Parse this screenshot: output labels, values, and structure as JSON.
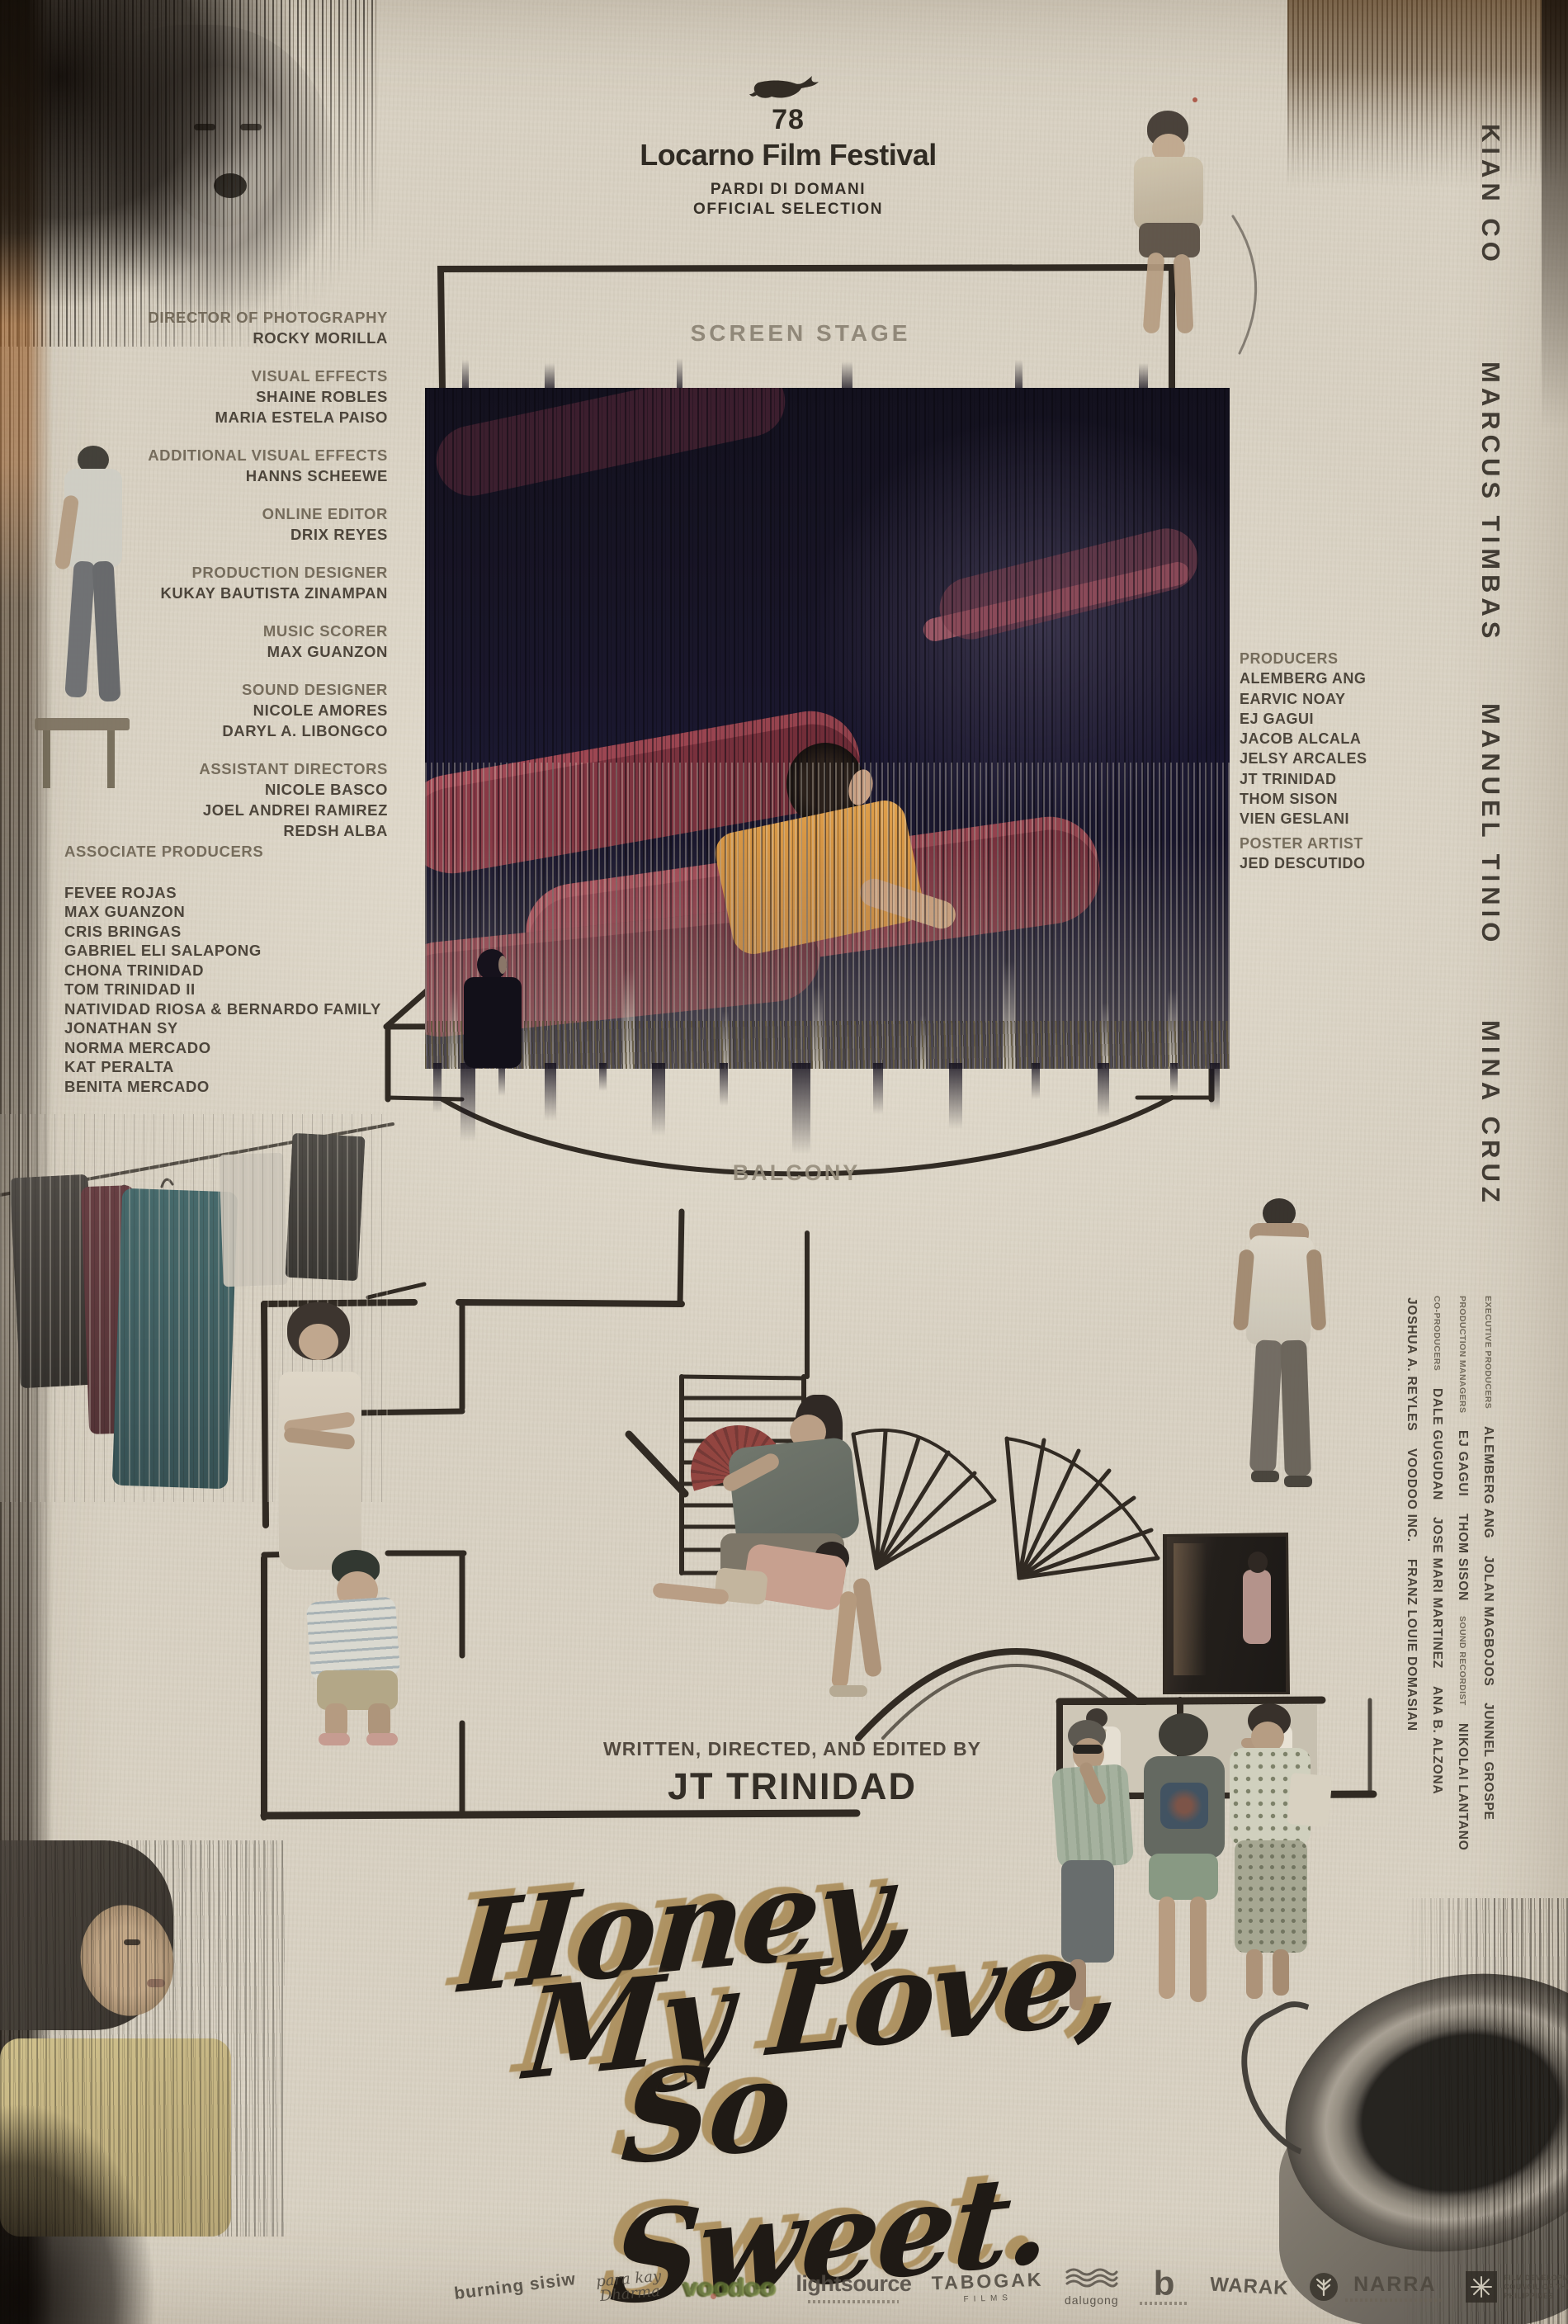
{
  "festival": {
    "edition": "78",
    "name": "Locarno Film Festival",
    "section1": "PARDI DI DOMANI",
    "section2": "OFFICIAL SELECTION"
  },
  "theater": {
    "screen_label": "SCREEN STAGE",
    "balcony_label": "BALCONY"
  },
  "credits_left": [
    {
      "role": "DIRECTOR OF PHOTOGRAPHY",
      "names": [
        "ROCKY MORILLA"
      ]
    },
    {
      "role": "VISUAL EFFECTS",
      "names": [
        "SHAINE ROBLES",
        "MARIA ESTELA PAISO"
      ]
    },
    {
      "role": "ADDITIONAL VISUAL EFFECTS",
      "names": [
        "HANNS SCHEEWE"
      ]
    },
    {
      "role": "ONLINE EDITOR",
      "names": [
        "DRIX REYES"
      ]
    },
    {
      "role": "PRODUCTION DESIGNER",
      "names": [
        "KUKAY BAUTISTA ZINAMPAN"
      ]
    },
    {
      "role": "MUSIC SCORER",
      "names": [
        "MAX GUANZON"
      ]
    },
    {
      "role": "SOUND DESIGNER",
      "names": [
        "NICOLE AMORES",
        "DARYL A. LIBONGCO"
      ]
    },
    {
      "role": "ASSISTANT DIRECTORS",
      "names": [
        "NICOLE BASCO",
        "JOEL ANDREI RAMIREZ",
        "REDSH ALBA"
      ]
    }
  ],
  "associate_producers": {
    "title": "ASSOCIATE PRODUCERS",
    "names": [
      "FEVEE ROJAS",
      "MAX GUANZON",
      "CRIS BRINGAS",
      "GABRIEL ELI SALAPONG",
      "CHONA TRINIDAD",
      "TOM TRINIDAD II",
      "NATIVIDAD RIOSA & BERNARDO FAMILY",
      "JONATHAN SY",
      "NORMA MERCADO",
      "KAT PERALTA",
      "BENITA MERCADO"
    ]
  },
  "producers": {
    "title": "PRODUCERS",
    "names": [
      "ALEMBERG ANG",
      "EARVIC NOAY",
      "EJ GAGUI",
      "JACOB ALCALA",
      "JELSY ARCALES",
      "JT TRINIDAD",
      "THOM SISON",
      "VIEN GESLANI"
    ]
  },
  "poster_artist": {
    "title": "POSTER ARTIST",
    "name": "JED DESCUTIDO"
  },
  "cast": [
    "KIAN CO",
    "MARCUS TIMBAS",
    "MANUEL TINIO",
    "MINA CRUZ"
  ],
  "side_credits": [
    {
      "items": [
        {
          "t": "label",
          "text": "EXECUTIVE PRODUCERS"
        },
        {
          "t": "name",
          "text": "ALEMBERG ANG"
        },
        {
          "t": "name",
          "text": "JOLAN MAGBOJOS"
        },
        {
          "t": "name",
          "text": "JUNNEL GROSPE"
        }
      ]
    },
    {
      "items": [
        {
          "t": "label",
          "text": "PRODUCTION MANAGERS"
        },
        {
          "t": "name",
          "text": "EJ GAGUI"
        },
        {
          "t": "name",
          "text": "THOM SISON"
        },
        {
          "t": "label",
          "text": "SOUND RECORDIST"
        },
        {
          "t": "name",
          "text": "NIKOLAI LANTANO"
        }
      ]
    },
    {
      "items": [
        {
          "t": "label",
          "text": "CO-PRODUCERS"
        },
        {
          "t": "name",
          "text": "DALE GUGUDAN"
        },
        {
          "t": "name",
          "text": "JOSE MARI MARTINEZ"
        },
        {
          "t": "name",
          "text": "ANA B. ALZONA"
        }
      ]
    },
    {
      "items": [
        {
          "t": "name",
          "text": "JOSHUA A. REYLES"
        },
        {
          "t": "name",
          "text": "VOODOO INC."
        },
        {
          "t": "name",
          "text": "FRANZ LOUIE DOMASIAN"
        }
      ]
    }
  ],
  "billing": {
    "credit": "WRITTEN, DIRECTED, AND EDITED BY",
    "name": "JT TRINIDAD"
  },
  "title": {
    "line1": "Honey,",
    "line2": "My Love,",
    "line3": "So Sweet."
  },
  "logos": {
    "burning": "burning sisiw",
    "para1": "para kay",
    "para2": "Dharma",
    "voodoo": "voodoo",
    "lightsource": "lightsource",
    "tabogak": "TABOGAK",
    "tabogak_sub": "FILMS",
    "dalugong": "dalugong",
    "b": "b",
    "warak": "WARAK",
    "narra": "NARRA",
    "fdcp": "FILM DEVELOPMENT COUNCIL OF THE PHILIPPINES"
  },
  "colors": {
    "paper": "#d8d1c2",
    "ink": "#241f19",
    "title_gold": "#b1945f",
    "seat_red": "#a04250",
    "screen_dark": "#171427",
    "credit_text": "#423b31"
  }
}
